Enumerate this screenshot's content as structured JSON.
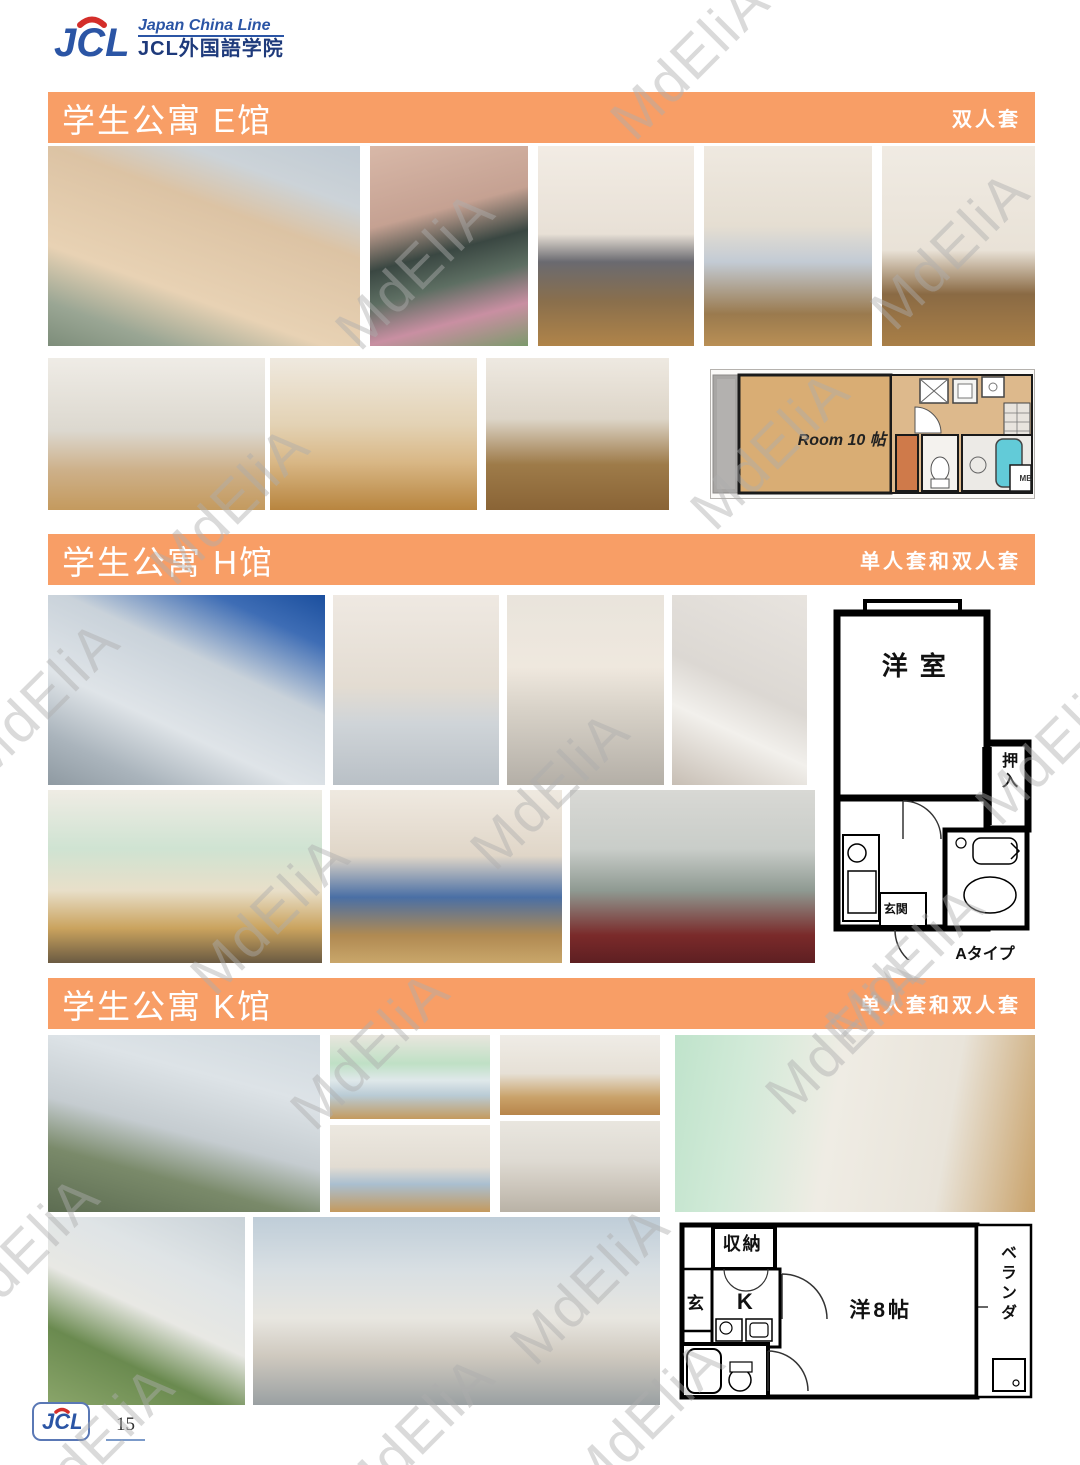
{
  "brand": {
    "logo_text": "JCL",
    "tagline": "Japan China Line",
    "org_name": "JCL外国語学院"
  },
  "watermark": {
    "text": "MdEliA"
  },
  "colors": {
    "accent_orange": "#f89e66",
    "logo_blue": "#2b55a5",
    "logo_navy": "#1e3a7b",
    "logo_red": "#d42e2a"
  },
  "sections": [
    {
      "title": "学生公寓 E馆",
      "subtitle": "双人套",
      "floorplan": {
        "room_label": "Room 10 帖",
        "mb_label": "MB"
      }
    },
    {
      "title": "学生公寓 H馆",
      "subtitle": "单人套和双人套",
      "floorplan": {
        "room_label": "洋室",
        "closet_label": "押入",
        "entrance_label": "玄関",
        "type_label": "Aタイプ"
      }
    },
    {
      "title": "学生公寓 K馆",
      "subtitle": "单人套和双人套",
      "floorplan": {
        "storage_label": "収納",
        "entrance_label": "玄",
        "kitchen_label": "K",
        "room_label": "洋8帖",
        "veranda_label": "ベランダ"
      }
    }
  ],
  "footer": {
    "logo_text": "JCL",
    "page_number": "15"
  }
}
